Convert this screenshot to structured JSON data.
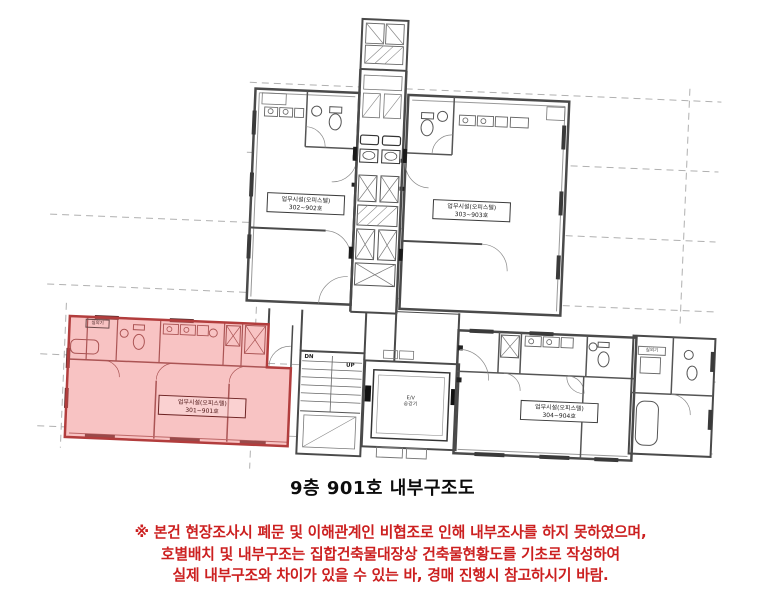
{
  "document": {
    "title": "9층 901호 내부구조도",
    "notice": {
      "color": "#cc2020",
      "line1": "※ 본건 현장조사시 폐문 및 이해관계인 비협조로 인해 내부조사를 하지 못하였으며,",
      "line2": "호별배치 및 내부구조는 집합건축물대장상 건축물현황도를 기초로 작성하여",
      "line3": "실제 내부구조와 차이가 있을 수 있는 바, 경매 진행시 참고하시기 바람."
    }
  },
  "plan": {
    "units": {
      "upper_left": {
        "line1": "업무시설(오피스텔)",
        "line2": "302~902호",
        "highlighted": false
      },
      "upper_right": {
        "line1": "업무시설(오피스텔)",
        "line2": "303~903호",
        "highlighted": false
      },
      "lower_left": {
        "line1": "업무시설(오피스텔)",
        "line2": "301~901호",
        "highlighted": true
      },
      "lower_right": {
        "line1": "업무시설(오피스텔)",
        "line2": "304~904호",
        "highlighted": false
      }
    },
    "stairs": {
      "down": "DN",
      "up": "UP"
    },
    "elevator": {
      "line1": "E/V",
      "line2": "승강기"
    },
    "small_rooms": {
      "outdoor_unit": "실외기"
    },
    "colors": {
      "highlight_fill": "#ee7070",
      "highlight_border": "#b23d3d",
      "wall_line": "#4a4a4a",
      "grid_line": "#b0b0b0"
    }
  }
}
